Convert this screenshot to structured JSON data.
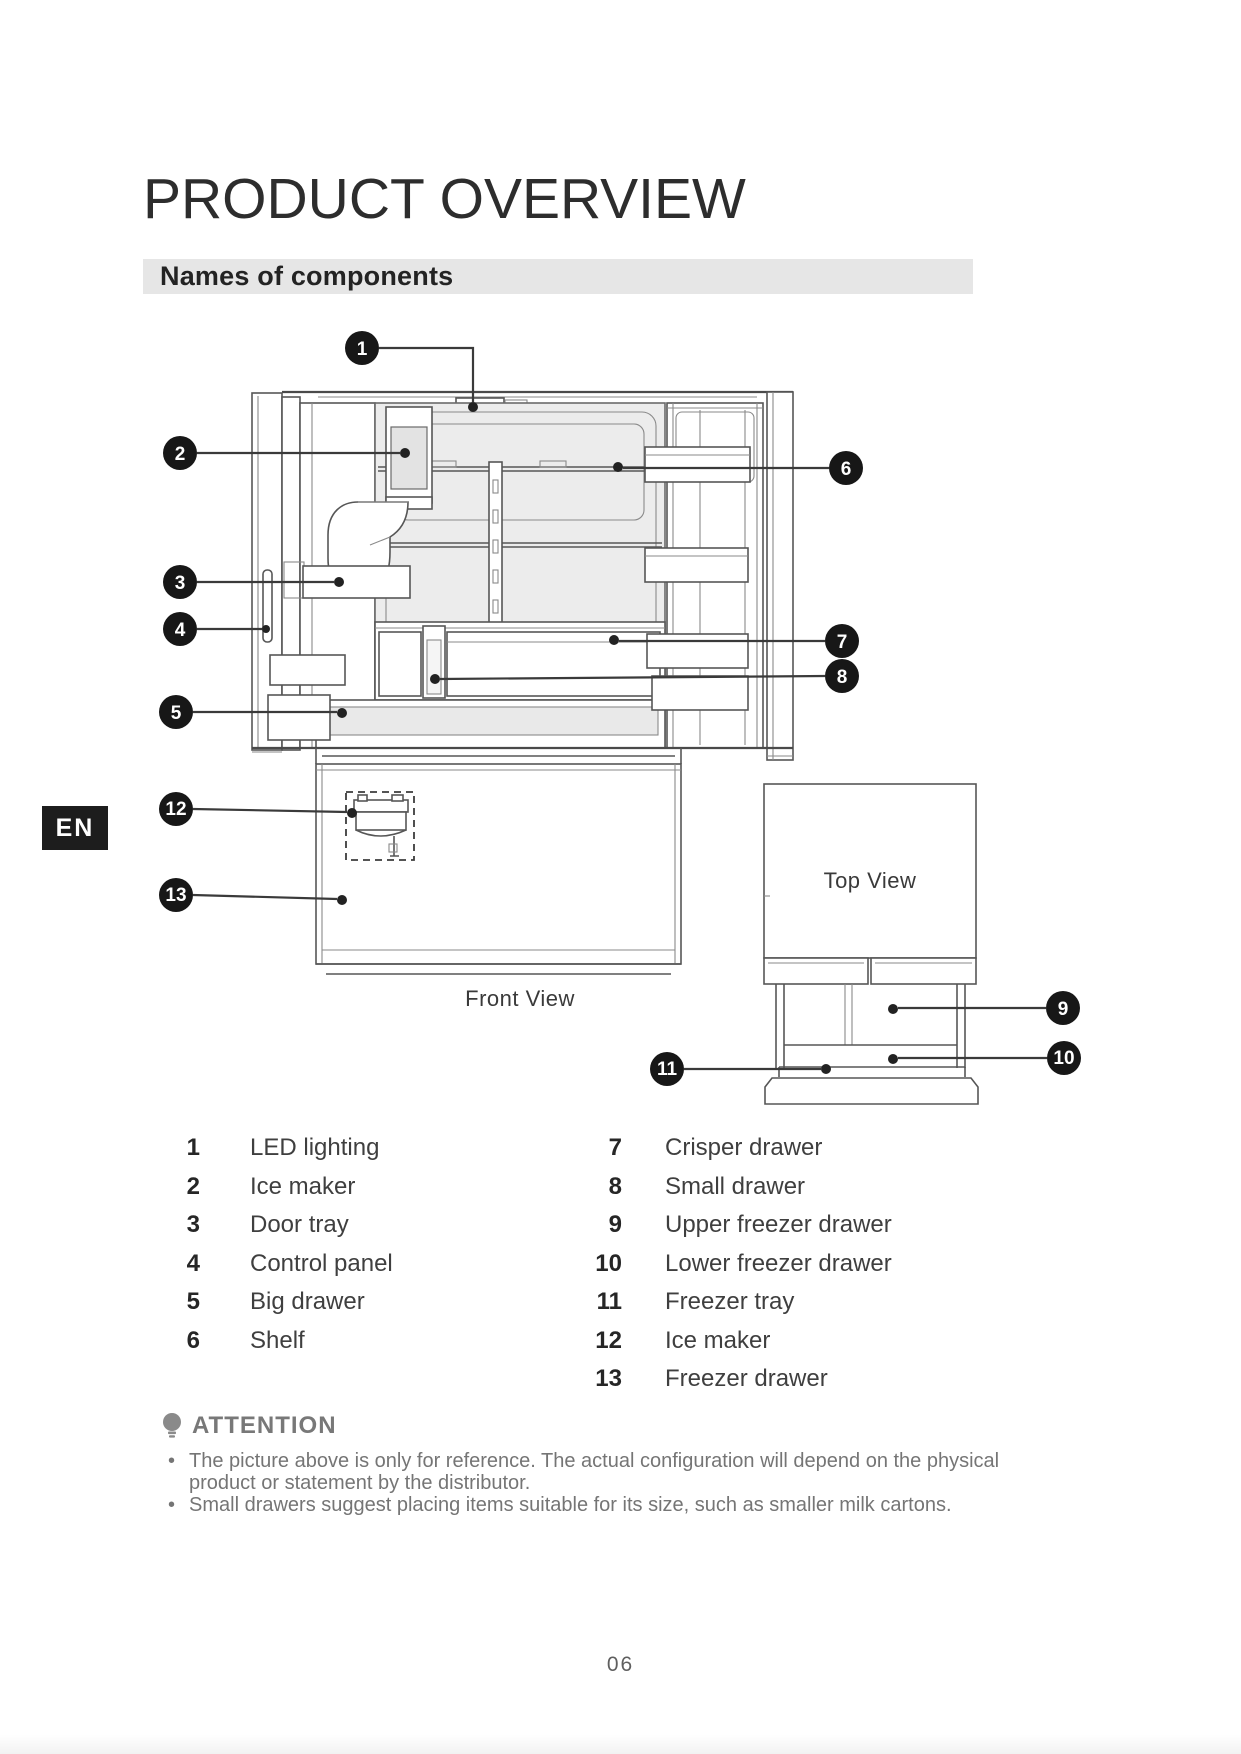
{
  "header": {
    "title": "PRODUCT OVERVIEW",
    "section": "Names of components"
  },
  "page": {
    "language_tab": "EN",
    "page_number": "06"
  },
  "figure": {
    "front_view_label": "Front View",
    "top_view_label": "Top View",
    "callouts": [
      "1",
      "2",
      "3",
      "4",
      "5",
      "6",
      "7",
      "8",
      "9",
      "10",
      "11",
      "12",
      "13"
    ]
  },
  "components": {
    "left": [
      {
        "num": "1",
        "label": "LED lighting"
      },
      {
        "num": "2",
        "label": "Ice maker"
      },
      {
        "num": "3",
        "label": "Door tray"
      },
      {
        "num": "4",
        "label": "Control panel"
      },
      {
        "num": "5",
        "label": "Big drawer"
      },
      {
        "num": "6",
        "label": "Shelf"
      }
    ],
    "right": [
      {
        "num": "7",
        "label": "Crisper drawer"
      },
      {
        "num": "8",
        "label": "Small drawer"
      },
      {
        "num": "9",
        "label": "Upper freezer drawer"
      },
      {
        "num": "10",
        "label": "Lower freezer drawer"
      },
      {
        "num": "11",
        "label": "Freezer tray"
      },
      {
        "num": "12",
        "label": "Ice maker"
      },
      {
        "num": "13",
        "label": "Freezer drawer"
      }
    ]
  },
  "attention": {
    "icon": "bulb-icon",
    "title": "ATTENTION",
    "notes": [
      "The picture above is only for reference. The actual configuration will depend on the physical product or statement by the distributor.",
      "Small drawers suggest placing items suitable for its size, such as smaller milk cartons."
    ]
  }
}
